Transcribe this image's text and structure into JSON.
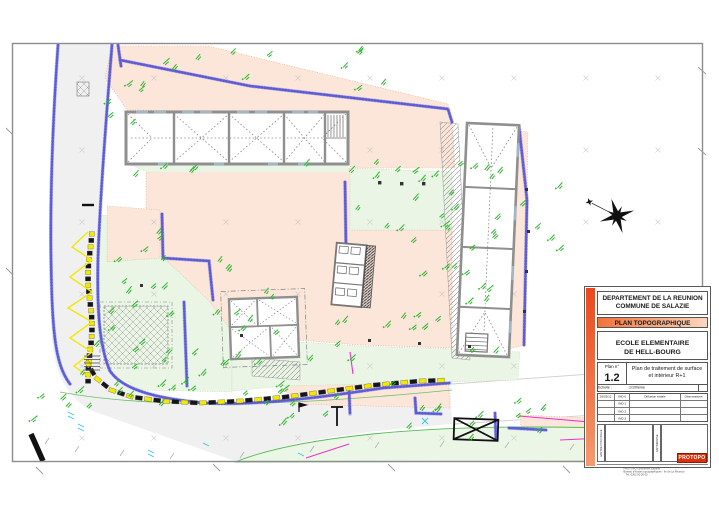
{
  "title_block": {
    "department": "DEPARTEMENT DE LA REUNION",
    "commune": "COMMUNE DE SALAZIE",
    "plan_type": "PLAN TOPOGRAPHIQUE",
    "school_line1": "ECOLE ELEMENTAIRE",
    "school_line2": "DE HELL-BOURG",
    "plan_no_label": "Plan n°",
    "plan_no": "1.2",
    "plan_desc_line1": "Plan de traitement de surface",
    "plan_desc_line2": "et intérieur R+1",
    "scale_label": "Echelle :",
    "scale_value": "1/100ème",
    "revisions": {
      "observations_header": "Observations",
      "rows": [
        {
          "date": "29/03/12",
          "ind": "IND 0",
          "label": "Diffusion initiale"
        },
        {
          "date": "",
          "ind": "IND 1",
          "label": ""
        },
        {
          "date": "",
          "ind": "IND 2",
          "label": ""
        },
        {
          "date": "",
          "ind": "IND 3",
          "label": ""
        }
      ]
    },
    "box_left_label": "MAITRE D'OUVRAGE",
    "box_right_label": "ENTREPRISE",
    "footer_line1": "PROTOPO Géomètres Experts",
    "footer_line2": "Bureau d'études topographiques - Ile de La Réunion",
    "footer_line3": "Tél. 0262 00 00 00",
    "logo": "PROTOPO"
  },
  "colors": {
    "accent": "#e8491d",
    "surface_peach": "#fbe6d9",
    "surface_green": "#eaf5e5",
    "wall_blue": "#5353d6",
    "barrier_yellow": "#f2e800",
    "annotation_green": "#2db52d",
    "magenta": "#ee33cc",
    "building_wall_gray": "#8f8f8f"
  }
}
